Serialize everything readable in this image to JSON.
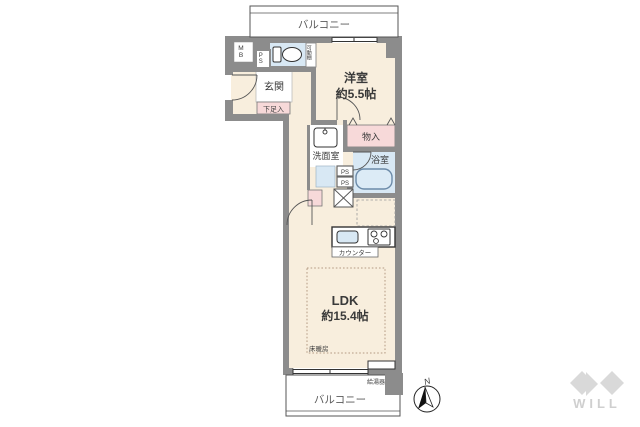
{
  "floorplan": {
    "balcony_top": "バルコニー",
    "balcony_bottom": "バルコニー",
    "western_room_name": "洋室",
    "western_room_size": "約5.5帖",
    "ldk_name": "LDK",
    "ldk_size": "約15.4帖",
    "entrance": "玄関",
    "shoe_cabinet": "下足入",
    "movable_shelf": "可動棚",
    "meter_box": "MB",
    "pipe_space_main": "PS",
    "pipe_space_duct1": "PS",
    "pipe_space_duct2": "PS",
    "storage": "物入",
    "washroom": "洗面室",
    "bathroom": "浴室",
    "counter": "カウンター",
    "floor_heating": "床暖房",
    "water_heater": "給湯器",
    "compass_north": "N"
  },
  "branding": {
    "logo": "WILL"
  },
  "colors": {
    "wall": "#8c8c8c",
    "room_cream": "#f8eedd",
    "wet_blue": "#d8e8f4",
    "storage_pink": "#f7d9d9",
    "logo_gray": "#d9d9d9"
  }
}
